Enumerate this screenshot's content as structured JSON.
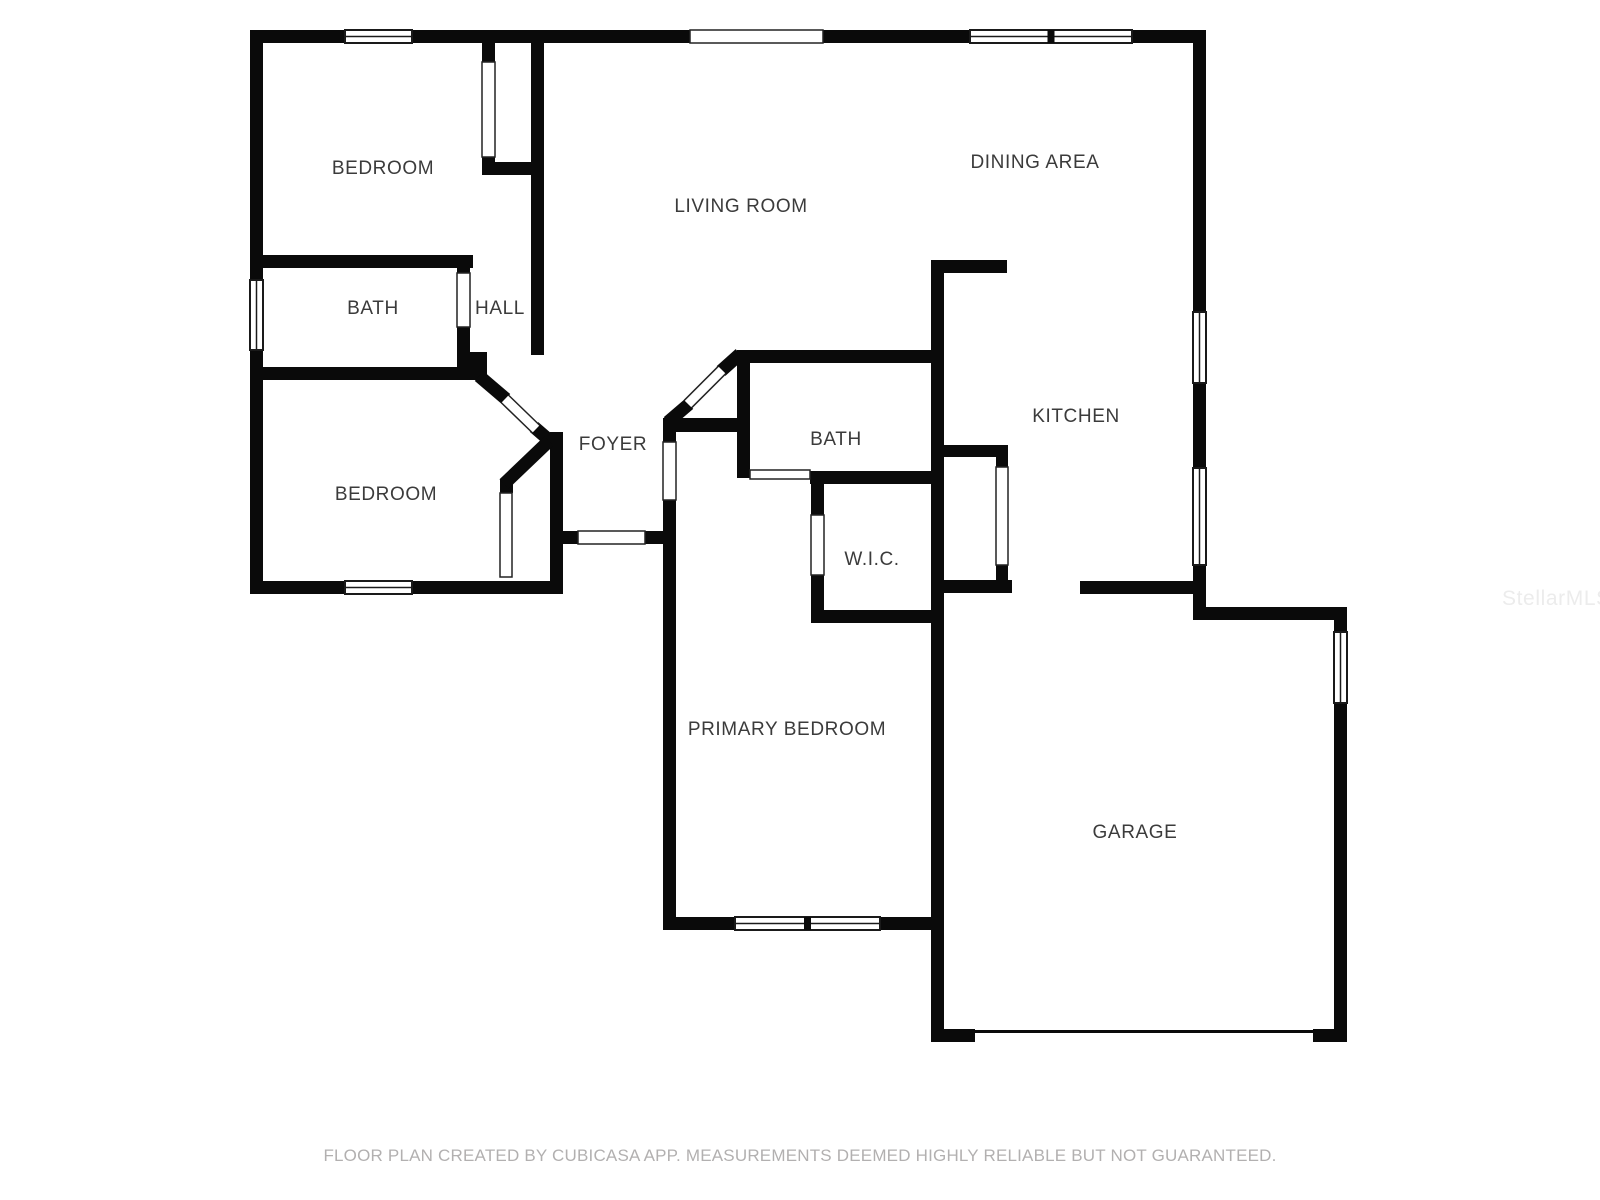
{
  "watermark": {
    "text": "StellarMLS"
  },
  "footer": {
    "text": "FLOOR PLAN CREATED BY CUBICASA APP. MEASUREMENTS DEEMED HIGHLY RELIABLE BUT NOT GUARANTEED."
  },
  "floorplan": {
    "wall_color": "#0a0a0a",
    "label_color": "#3b3b3b",
    "opening_stroke": "#222222",
    "window_stroke": "#1a1a1a",
    "wall_thickness": 13,
    "rooms": [
      {
        "name": "bedroom-1",
        "label": "BEDROOM",
        "cx": 383,
        "cy": 169
      },
      {
        "name": "living-room",
        "label": "LIVING ROOM",
        "cx": 741,
        "cy": 207
      },
      {
        "name": "dining-area",
        "label": "DINING AREA",
        "cx": 1035,
        "cy": 163
      },
      {
        "name": "bath-1",
        "label": "BATH",
        "cx": 373,
        "cy": 309
      },
      {
        "name": "hall",
        "label": "HALL",
        "cx": 500,
        "cy": 309
      },
      {
        "name": "bedroom-2",
        "label": "BEDROOM",
        "cx": 386,
        "cy": 495
      },
      {
        "name": "foyer",
        "label": "FOYER",
        "cx": 613,
        "cy": 445
      },
      {
        "name": "bath-2",
        "label": "BATH",
        "cx": 836,
        "cy": 440
      },
      {
        "name": "kitchen",
        "label": "KITCHEN",
        "cx": 1076,
        "cy": 417
      },
      {
        "name": "wic",
        "label": "W.I.C.",
        "cx": 872,
        "cy": 560
      },
      {
        "name": "primary-bedroom",
        "label": "PRIMARY BEDROOM",
        "cx": 787,
        "cy": 730
      },
      {
        "name": "garage",
        "label": "GARAGE",
        "cx": 1135,
        "cy": 833
      }
    ],
    "walls": [
      [
        250,
        30,
        95,
        13
      ],
      [
        412,
        30,
        278,
        13
      ],
      [
        823,
        30,
        147,
        13
      ],
      [
        1132,
        30,
        74,
        13
      ],
      [
        250,
        30,
        13,
        250
      ],
      [
        250,
        350,
        13,
        244
      ],
      [
        1193,
        30,
        13,
        282
      ],
      [
        1193,
        383,
        13,
        85
      ],
      [
        1193,
        565,
        13,
        55
      ],
      [
        263,
        255,
        210,
        13
      ],
      [
        457,
        255,
        13,
        18
      ],
      [
        457,
        327,
        13,
        53
      ],
      [
        250,
        367,
        226,
        13
      ],
      [
        470,
        352,
        17,
        28
      ],
      [
        482,
        43,
        13,
        19
      ],
      [
        482,
        157,
        13,
        18
      ],
      [
        482,
        162,
        49,
        13
      ],
      [
        531,
        43,
        13,
        312
      ],
      [
        250,
        581,
        95,
        13
      ],
      [
        412,
        581,
        151,
        13
      ],
      [
        550,
        432,
        13,
        162
      ],
      [
        500,
        479,
        13,
        14
      ],
      [
        563,
        531,
        15,
        13
      ],
      [
        645,
        531,
        18,
        13
      ],
      [
        663,
        418,
        87,
        14
      ],
      [
        663,
        432,
        13,
        10
      ],
      [
        663,
        500,
        13,
        430
      ],
      [
        737,
        355,
        13,
        123
      ],
      [
        737,
        350,
        207,
        13
      ],
      [
        810,
        471,
        134,
        13
      ],
      [
        811,
        484,
        13,
        31
      ],
      [
        811,
        575,
        13,
        48
      ],
      [
        811,
        610,
        133,
        13
      ],
      [
        931,
        260,
        13,
        782
      ],
      [
        931,
        260,
        76,
        13
      ],
      [
        944,
        445,
        64,
        12
      ],
      [
        996,
        457,
        12,
        10
      ],
      [
        996,
        565,
        12,
        16
      ],
      [
        944,
        580,
        68,
        13
      ],
      [
        1080,
        581,
        126,
        13
      ],
      [
        1205,
        607,
        142,
        13
      ],
      [
        1334,
        607,
        13,
        25
      ],
      [
        1334,
        703,
        13,
        339
      ],
      [
        931,
        1029,
        44,
        13
      ],
      [
        1313,
        1029,
        34,
        13
      ],
      [
        663,
        917,
        72,
        13
      ],
      [
        880,
        917,
        64,
        13
      ]
    ],
    "diagonal_walls": [
      [
        479,
        376,
        506,
        399
      ],
      [
        534,
        427,
        556,
        446
      ],
      [
        549,
        441,
        504,
        484
      ],
      [
        668,
        422,
        689,
        404
      ],
      [
        721,
        371,
        740,
        354
      ]
    ],
    "door_leaves": [
      [
        505,
        399,
        536,
        429
      ],
      [
        688,
        404,
        722,
        370
      ]
    ],
    "door_openings": [
      [
        690,
        30,
        133,
        13
      ],
      [
        578,
        531,
        67,
        13
      ],
      [
        482,
        62,
        13,
        95
      ],
      [
        457,
        273,
        13,
        54
      ],
      [
        500,
        493,
        12,
        84
      ],
      [
        663,
        442,
        13,
        58
      ],
      [
        750,
        470,
        60,
        9
      ],
      [
        811,
        515,
        13,
        60
      ],
      [
        996,
        467,
        12,
        98
      ]
    ],
    "windows": [
      {
        "x": 345,
        "y": 30,
        "w": 67,
        "h": 13,
        "o": "h",
        "panes": 1
      },
      {
        "x": 970,
        "y": 30,
        "w": 162,
        "h": 13,
        "o": "h",
        "panes": 2
      },
      {
        "x": 250,
        "y": 280,
        "w": 13,
        "h": 70,
        "o": "v",
        "panes": 1
      },
      {
        "x": 345,
        "y": 581,
        "w": 67,
        "h": 13,
        "o": "h",
        "panes": 1
      },
      {
        "x": 1193,
        "y": 312,
        "w": 13,
        "h": 71,
        "o": "v",
        "panes": 1
      },
      {
        "x": 1193,
        "y": 468,
        "w": 13,
        "h": 97,
        "o": "v",
        "panes": 1
      },
      {
        "x": 1334,
        "y": 632,
        "w": 13,
        "h": 71,
        "o": "v",
        "panes": 1
      },
      {
        "x": 735,
        "y": 917,
        "w": 145,
        "h": 13,
        "o": "h",
        "panes": 2
      }
    ],
    "garage_door": {
      "x": 975,
      "y": 1029,
      "w": 338,
      "h": 13,
      "line_h": 3
    }
  }
}
